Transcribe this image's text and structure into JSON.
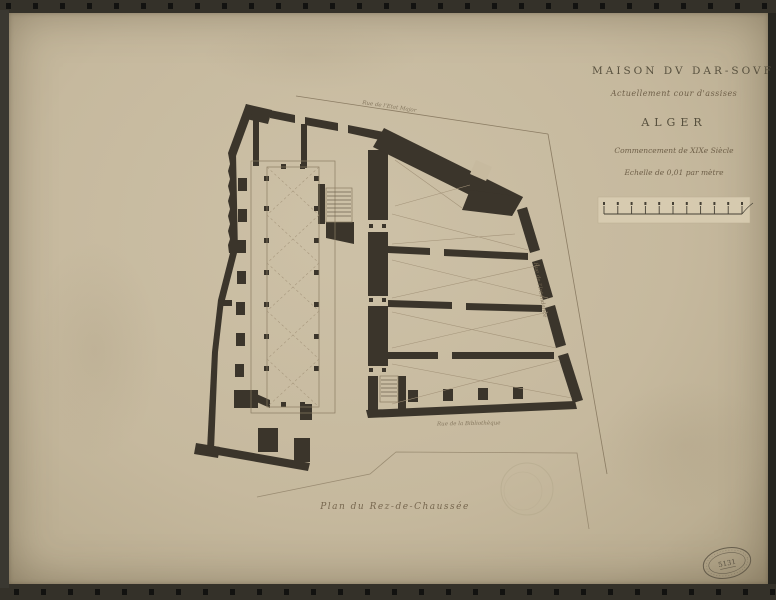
{
  "document": {
    "kind": "archival photograph of an architectural floor plan",
    "caption": "Plan du Rez-de-Chaussée"
  },
  "title_block": {
    "line1": "MAISON DV DAR-SOVF",
    "line2": "Actuellement cour d'assises",
    "city": "ALGER",
    "period": "Commencement de XIXe Siècle",
    "scale_note": "Echelle de 0,01 par mètre"
  },
  "street_labels": {
    "top": "Rue de l'Etat Major",
    "right": "Rue de l'Intendance",
    "bottom": "Rue de la Bibliothèque"
  },
  "scale_bar": {
    "divisions": 10,
    "ticks": 11
  },
  "stamp": {
    "number": "5131"
  },
  "colors": {
    "paper": "#c6b99e",
    "ink": "#3b352b",
    "thin_line": "#8b7c63",
    "text": "#5d5340",
    "frame": "#26251f"
  }
}
